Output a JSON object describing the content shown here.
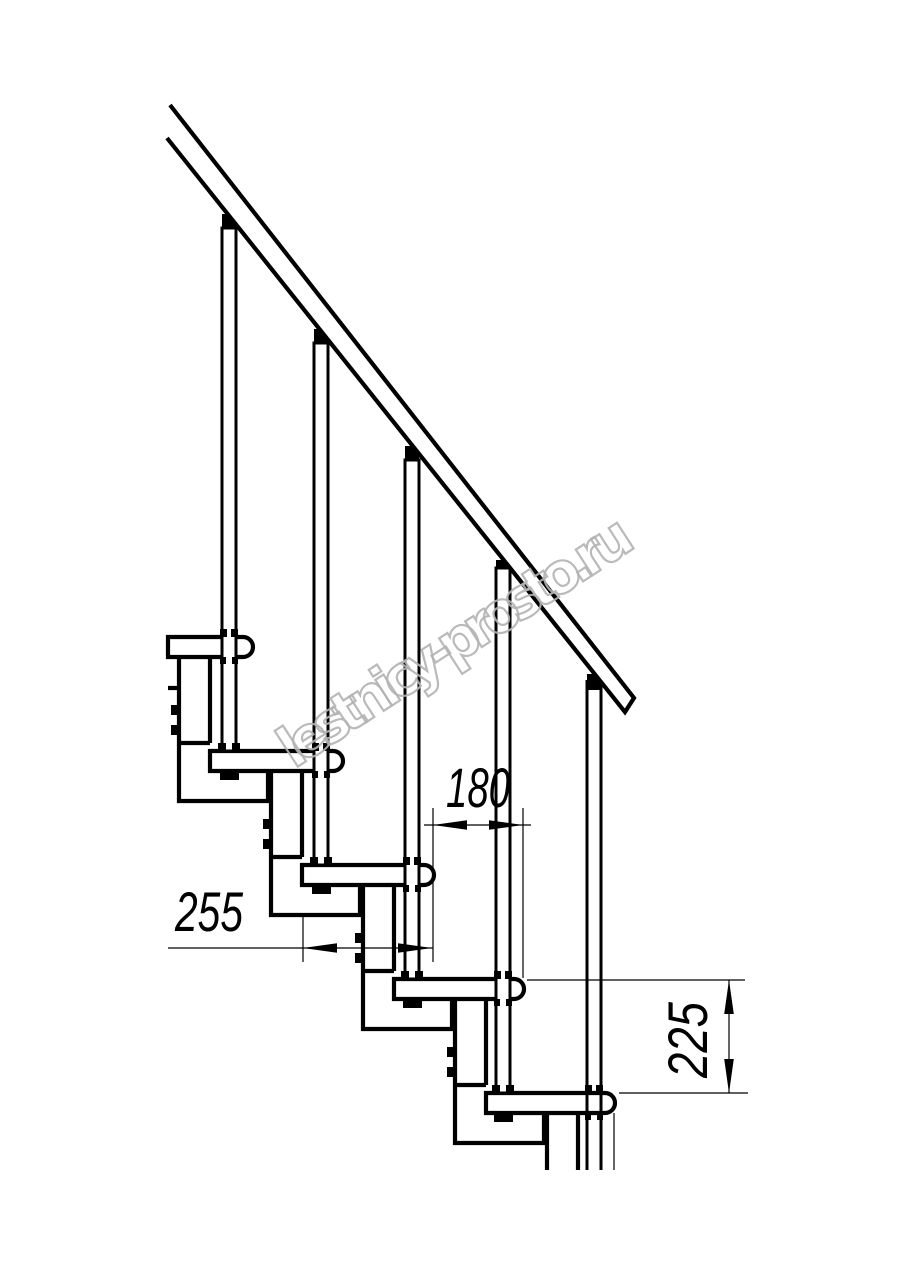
{
  "drawing": {
    "description": "Side-view technical drawing of a modular staircase with handrail, balusters, treads and central support modules",
    "line_color": "#000000",
    "background_color": "#ffffff",
    "steps_visible": 5,
    "balusters_visible": 5,
    "dimensions": {
      "tread_depth_label": "255",
      "step_run_label": "180",
      "step_rise_label": "225"
    },
    "watermark": {
      "text": "lestnicy-prosto.ru",
      "color": "#b2b2b2"
    }
  }
}
